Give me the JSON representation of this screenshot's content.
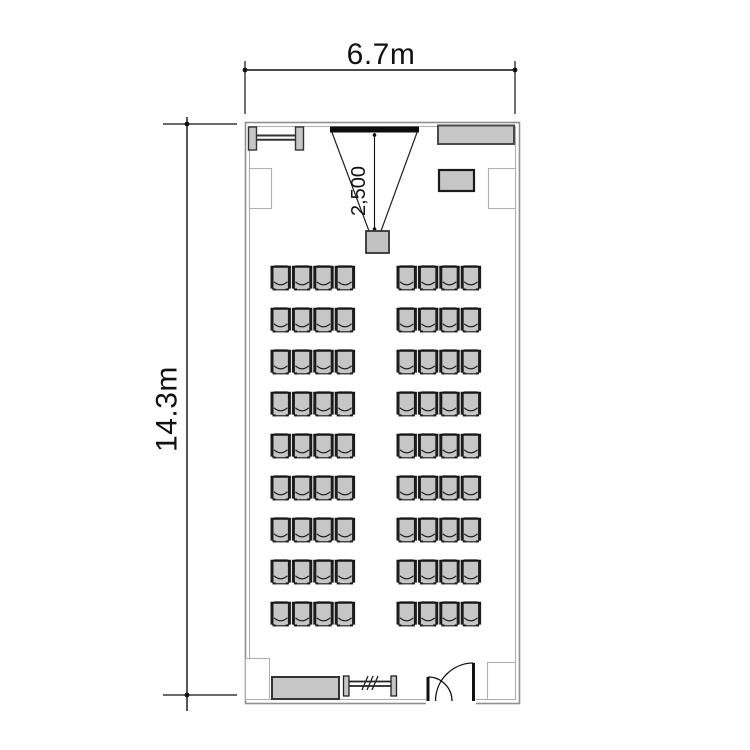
{
  "labels": {
    "room_width": "6.7m",
    "room_height": "14.3m",
    "projection_distance": "2,500"
  },
  "seating": {
    "rows": 9,
    "blocks_per_row": 2,
    "seats_per_block": 4,
    "total_seats": 72
  },
  "fixtures": [
    {
      "name": "radiator-top"
    },
    {
      "name": "projection-screen"
    },
    {
      "name": "projector"
    },
    {
      "name": "cabinet"
    },
    {
      "name": "lectern"
    },
    {
      "name": "sideboard"
    },
    {
      "name": "radiator-bottom"
    },
    {
      "name": "entrance-door"
    }
  ],
  "colors": {
    "wall_line": "#8f8f8f",
    "inner_wall_line": "#b0b0b0",
    "furniture_fill": "#c6c6c6",
    "furniture_outline": "#333333",
    "chair_outline": "#1a1a1a",
    "screen": "#0d0d0d",
    "dimension_line": "#111111"
  }
}
